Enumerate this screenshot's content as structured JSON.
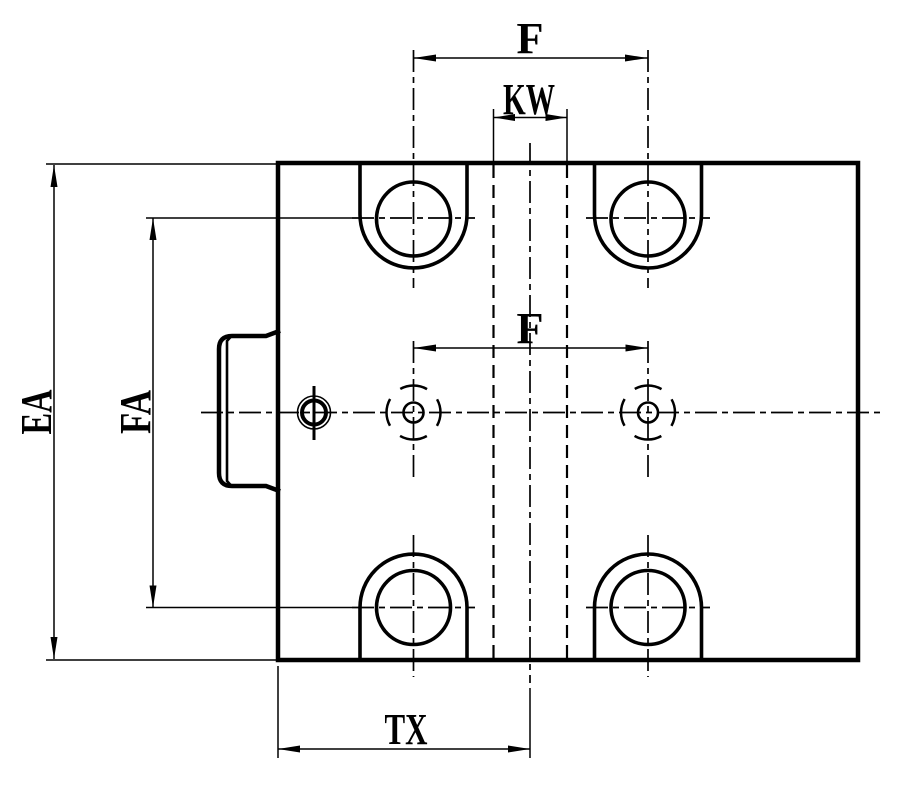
{
  "drawing": {
    "background_color": "#ffffff",
    "line_color": "#000000",
    "dimension_labels": {
      "f_top": "F",
      "kw": "KW",
      "f_middle": "F",
      "ea": "EA",
      "fa": "FA",
      "tx": "TX"
    }
  }
}
